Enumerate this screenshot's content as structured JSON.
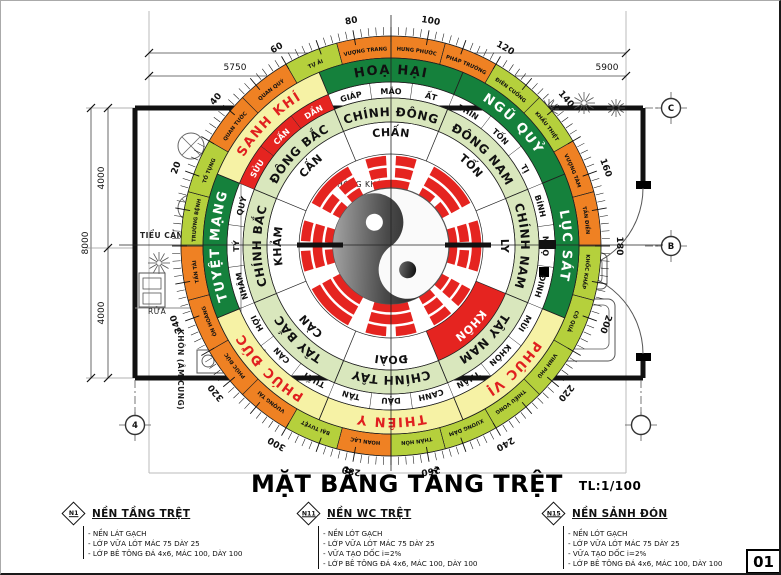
{
  "title": {
    "text": "MẶT BẰNG TẦNG TRỆT",
    "scale": "TL:1/100"
  },
  "sheet_number": "01",
  "dimensions": {
    "top": [
      "5750",
      "5900"
    ],
    "left": [
      "4000",
      "8000",
      "4000"
    ]
  },
  "grid_bubbles": [
    "C",
    "B",
    "4",
    ""
  ],
  "plan": {
    "room": "PHÒNG KHÁCH",
    "garden": "TIỂU CẢNH",
    "wash": "RỬA",
    "corner": "KHÔN (ÂM CUNG)"
  },
  "compass": {
    "degree_labels": [
      20,
      40,
      60,
      80,
      100,
      120,
      140,
      160,
      180,
      200,
      220,
      240,
      260,
      280,
      300,
      320,
      340
    ],
    "energies": [
      {
        "label": "HOẠ HẠI",
        "bg": "#15813c",
        "fg": "#111111"
      },
      {
        "label": "NGŨ QUỶ",
        "bg": "#15813c",
        "fg": "#ffffff"
      },
      {
        "label": "LỤC SÁT",
        "bg": "#15813c",
        "fg": "#ffffff"
      },
      {
        "label": "PHÚC VỊ",
        "bg": "#f6f2a5",
        "fg": "#e01f1f"
      },
      {
        "label": "THIÊN Y",
        "bg": "#f6f2a5",
        "fg": "#e01f1f"
      },
      {
        "label": "PHÚC ĐỨC",
        "bg": "#f6f2a5",
        "fg": "#e01f1f"
      },
      {
        "label": "TUYỆT MẠNG",
        "bg": "#15813c",
        "fg": "#ffffff"
      },
      {
        "label": "SANH KHÍ",
        "bg": "#f6f2a5",
        "fg": "#e01f1f"
      }
    ],
    "directions": [
      "CHÍNH ĐÔNG",
      "ĐÔNG NAM",
      "CHÍNH NAM",
      "TÂY NAM",
      "CHÍNH TÂY",
      "TÂY BẮC",
      "CHÍNH BẮC",
      "ĐÔNG BẮC"
    ],
    "trigrams": [
      {
        "label": "CHẤN",
        "lines": [
          1,
          0,
          0
        ],
        "red": false
      },
      {
        "label": "TỐN",
        "lines": [
          0,
          1,
          1
        ],
        "red": false
      },
      {
        "label": "LY",
        "lines": [
          1,
          0,
          1
        ],
        "red": false
      },
      {
        "label": "KHÔN",
        "lines": [
          0,
          0,
          0
        ],
        "red": true
      },
      {
        "label": "ĐOÀI",
        "lines": [
          1,
          1,
          0
        ],
        "red": false
      },
      {
        "label": "CÀN",
        "lines": [
          1,
          1,
          1
        ],
        "red": false
      },
      {
        "label": "KHẢM",
        "lines": [
          0,
          1,
          0
        ],
        "red": false
      },
      {
        "label": "CẤN",
        "lines": [
          0,
          0,
          1
        ],
        "red": false
      }
    ],
    "mountains": [
      {
        "label": "GIÁP",
        "red": false
      },
      {
        "label": "MÃO",
        "red": false
      },
      {
        "label": "ẤT",
        "red": false
      },
      {
        "label": "THÌN",
        "red": false
      },
      {
        "label": "TỐN",
        "red": false
      },
      {
        "label": "TỊ",
        "red": false
      },
      {
        "label": "BÍNH",
        "red": false
      },
      {
        "label": "NGỌ",
        "red": false
      },
      {
        "label": "ĐINH",
        "red": false
      },
      {
        "label": "MÙI",
        "red": false
      },
      {
        "label": "KHÔN",
        "red": false
      },
      {
        "label": "THÂN",
        "red": false
      },
      {
        "label": "CANH",
        "red": false
      },
      {
        "label": "DẬU",
        "red": false
      },
      {
        "label": "TÂN",
        "red": false
      },
      {
        "label": "TUẤT",
        "red": false
      },
      {
        "label": "CÀN",
        "red": false
      },
      {
        "label": "HỢI",
        "red": false
      },
      {
        "label": "NHÂM",
        "red": false
      },
      {
        "label": "TÝ",
        "red": false
      },
      {
        "label": "QUÝ",
        "red": false
      },
      {
        "label": "SỬU",
        "red": true
      },
      {
        "label": "CẤN",
        "red": true
      },
      {
        "label": "DẦN",
        "red": true
      }
    ],
    "stars": [
      {
        "label": "VƯỢNG TRANG",
        "tone": "orange"
      },
      {
        "label": "HƯNG PHƯỚC",
        "tone": "orange"
      },
      {
        "label": "PHÁP TRƯỜNG",
        "tone": "orange"
      },
      {
        "label": "ĐIÊN CUỒNG",
        "tone": "green"
      },
      {
        "label": "KHẨU THIỆT",
        "tone": "green"
      },
      {
        "label": "VƯỢNG TÀM",
        "tone": "orange"
      },
      {
        "label": "TẤN ĐIỀN",
        "tone": "orange"
      },
      {
        "label": "KHỐC KHẤP",
        "tone": "green"
      },
      {
        "label": "CÔ QUẢ",
        "tone": "green"
      },
      {
        "label": "VINH PHÚ",
        "tone": "green"
      },
      {
        "label": "THIẾU VONG",
        "tone": "green"
      },
      {
        "label": "XƯƠNG DÂM",
        "tone": "green"
      },
      {
        "label": "THÂN HÔN",
        "tone": "green"
      },
      {
        "label": "HOAN LẠC",
        "tone": "orange"
      },
      {
        "label": "BẠI TUYỆT",
        "tone": "green"
      },
      {
        "label": "VƯỢNG TÀI",
        "tone": "orange"
      },
      {
        "label": "PHÚC ĐỨC",
        "tone": "orange"
      },
      {
        "label": "ÔN HOÀNG",
        "tone": "orange"
      },
      {
        "label": "TẤN TÀI",
        "tone": "orange"
      },
      {
        "label": "TRƯỜNG BỆNH",
        "tone": "green"
      },
      {
        "label": "TỐ TỤNG",
        "tone": "green"
      },
      {
        "label": "QUAN TƯỚC",
        "tone": "orange"
      },
      {
        "label": "QUAN QUÝ",
        "tone": "orange"
      },
      {
        "label": "TỰ ẢI",
        "tone": "green"
      }
    ]
  },
  "notes": [
    {
      "tag": "N1",
      "title": "NỀN TẦNG TRỆT",
      "items": [
        "NỀN LÁT GẠCH",
        "LỚP VỮA LÓT MÁC 75 DÀY 25",
        "LỚP BÊ TÔNG ĐÁ 4x6, MÁC 100, DÀY 100"
      ]
    },
    {
      "tag": "N11",
      "title": "NỀN WC TRỆT",
      "items": [
        "NỀN LÓT GẠCH",
        "LỚP VỮA LÓT MÁC 75 DÀY 25",
        "VỮA TẠO DỐC i=2%",
        "LỚP BÊ TÔNG ĐÁ 4x6, MÁC 100, DÀY 100"
      ]
    },
    {
      "tag": "N15",
      "title": "NỀN SẢNH ĐÓN",
      "items": [
        "NỀN LÓT GẠCH",
        "LỚP VỮA LÓT MÁC 75 DÀY 25",
        "VỮA TẠO DỐC i=2%",
        "LỚP BÊ TÔNG ĐÁ 4x6, MÁC 100, DÀY 100"
      ]
    }
  ],
  "colors": {
    "bad_bg": "#15813c",
    "good_bg": "#f6f2a5",
    "good_fg": "#e01f1f",
    "direction_ring": "#d9e7bd",
    "red": "#e52420",
    "orange": "#ef8123",
    "green": "#b5d03c"
  }
}
